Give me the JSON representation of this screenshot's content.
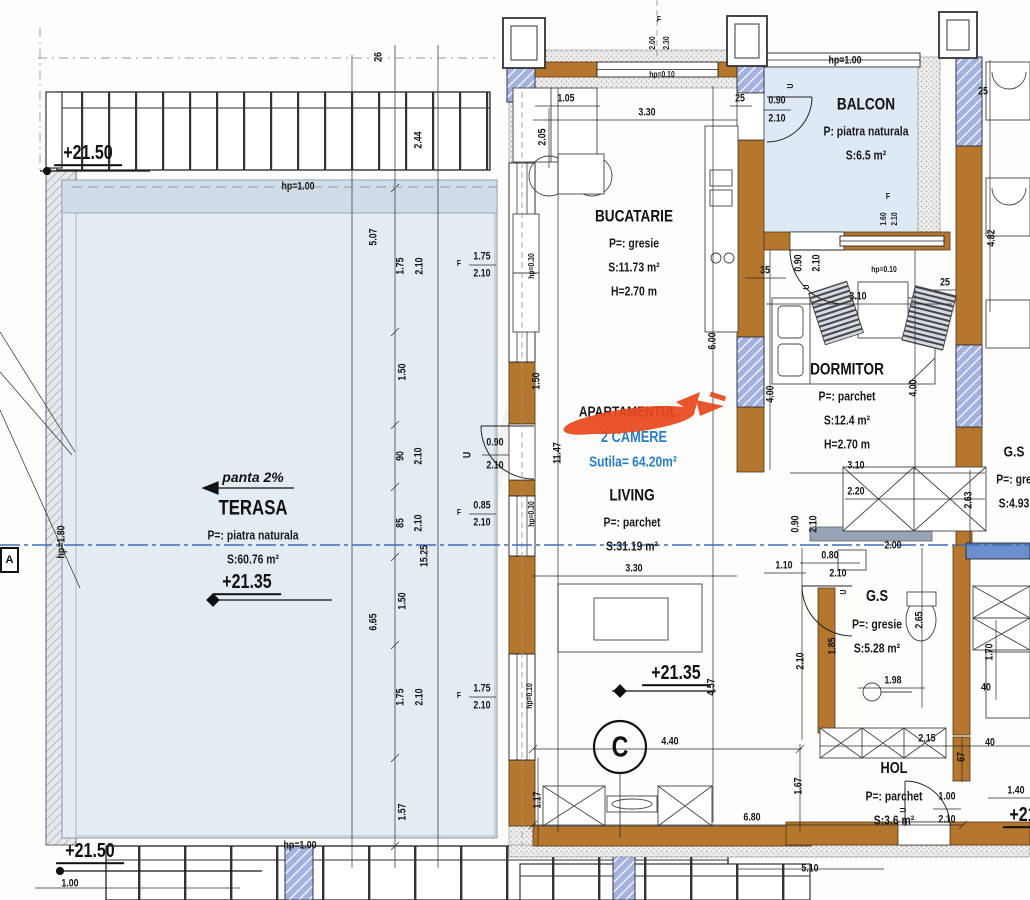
{
  "title_block": {
    "hidden_label": "APARTAMENTUL",
    "rooms_line": "2 CAMERE",
    "area_line": "Sutila= 64.20m²"
  },
  "annotations": {
    "slope": "panta 2%",
    "grid_c": "C",
    "grid_a": "A",
    "watermark": "TM"
  },
  "colors": {
    "wall_brown": "#b5762d",
    "column_blue": "#a3b2de",
    "floor_blue": "#e4ecf3",
    "balcony_blue": "#dde9f5",
    "axis_blue": "#3f6db5",
    "accent_red": "#e8481c",
    "text_blue": "#2b7cc4"
  },
  "rooms": [
    {
      "id": "bucatarie",
      "title": "BUCATARIE",
      "ts": 17,
      "x": 634,
      "y": 216,
      "lines": [
        "P=: gresie",
        "S:11.73 m²",
        "H=2.70 m"
      ]
    },
    {
      "id": "balcon",
      "title": "BALCON",
      "ts": 17,
      "x": 866,
      "y": 104,
      "lines": [
        "P: piatra naturala",
        "S:6.5 m²"
      ]
    },
    {
      "id": "dormitor",
      "title": "DORMITOR",
      "ts": 17,
      "x": 847,
      "y": 369,
      "lines": [
        "P=: parchet",
        "S:12.4 m²",
        "H=2.70 m"
      ]
    },
    {
      "id": "living",
      "title": "LIVING",
      "ts": 17,
      "x": 632,
      "y": 495,
      "lines": [
        "P=: parchet",
        "S:31.19 m²"
      ]
    },
    {
      "id": "terasa",
      "title": "TERASA",
      "ts": 21,
      "x": 253,
      "y": 508,
      "lines": [
        "P=: piatra naturala",
        "S:60.76 m²"
      ]
    },
    {
      "id": "gs-center",
      "title": "G.S",
      "ts": 16,
      "x": 877,
      "y": 597,
      "lines": [
        "P=: gresie",
        "S:5.28 m²"
      ]
    },
    {
      "id": "gs-right",
      "title": "G.S",
      "ts": 15,
      "x": 1014,
      "y": 452,
      "lines": [
        "P=: gre",
        "S:4.93"
      ]
    },
    {
      "id": "hol",
      "title": "HOL",
      "ts": 16,
      "x": 894,
      "y": 769,
      "lines": [
        "P=: parchet",
        "S:3.6 m²"
      ]
    }
  ],
  "elevations": [
    {
      "t": "+21.50",
      "x": 88,
      "y": 157
    },
    {
      "t": "+21.50",
      "x": 90,
      "y": 855
    },
    {
      "t": "+21.35",
      "x": 247,
      "y": 586
    },
    {
      "t": "+21.35",
      "x": 676,
      "y": 677
    },
    {
      "t": "+21",
      "x": 1023,
      "y": 819
    }
  ],
  "dims": [
    {
      "t": "26",
      "x": 379,
      "y": 57,
      "v": 1
    },
    {
      "t": "2.44",
      "x": 419,
      "y": 140,
      "v": 1
    },
    {
      "t": "5.07",
      "x": 374,
      "y": 237,
      "v": 1
    },
    {
      "t": "1.75",
      "x": 401,
      "y": 266,
      "v": 1
    },
    {
      "t": "2.10",
      "x": 420,
      "y": 266,
      "v": 1
    },
    {
      "t": "1.50",
      "x": 403,
      "y": 372,
      "v": 1
    },
    {
      "t": "90",
      "x": 401,
      "y": 456,
      "v": 1
    },
    {
      "t": "2.10",
      "x": 419,
      "y": 456,
      "v": 1
    },
    {
      "t": "85",
      "x": 401,
      "y": 523,
      "v": 1
    },
    {
      "t": "2.10",
      "x": 419,
      "y": 523,
      "v": 1
    },
    {
      "t": "1.50",
      "x": 403,
      "y": 601,
      "v": 1
    },
    {
      "t": "6.65",
      "x": 374,
      "y": 622,
      "v": 1
    },
    {
      "t": "15.25",
      "x": 425,
      "y": 556,
      "v": 1
    },
    {
      "t": "1.75",
      "x": 401,
      "y": 697,
      "v": 1
    },
    {
      "t": "2.10",
      "x": 420,
      "y": 697,
      "v": 1
    },
    {
      "t": "1.57",
      "x": 403,
      "y": 812,
      "v": 1
    },
    {
      "t": "hp=1.00",
      "x": 298,
      "y": 187
    },
    {
      "t": "hp=1.00",
      "x": 300,
      "y": 846
    },
    {
      "t": "1.00",
      "x": 70,
      "y": 884
    },
    {
      "t": "hp=1.80",
      "x": 62,
      "y": 542,
      "v": 1
    },
    {
      "t": "F",
      "x": 659,
      "y": 19,
      "s": 1
    },
    {
      "t": "2.00",
      "x": 652,
      "y": 43,
      "v": 1,
      "s": 1
    },
    {
      "t": "2.30",
      "x": 666,
      "y": 43,
      "v": 1,
      "s": 1
    },
    {
      "t": "hp=0.10",
      "x": 662,
      "y": 74,
      "s": 1
    },
    {
      "t": "1.05",
      "x": 566,
      "y": 99
    },
    {
      "t": "3.30",
      "x": 647,
      "y": 113
    },
    {
      "t": "2.05",
      "x": 543,
      "y": 137,
      "v": 1
    },
    {
      "t": "25",
      "x": 740,
      "y": 99
    },
    {
      "t": "0.90",
      "x": 777,
      "y": 101
    },
    {
      "t": "2.10",
      "x": 777,
      "y": 119
    },
    {
      "t": "U",
      "x": 790,
      "y": 86,
      "v": 1,
      "s": 1
    },
    {
      "t": "hp=1.00",
      "x": 845,
      "y": 61
    },
    {
      "t": "F",
      "x": 888,
      "y": 196,
      "s": 1
    },
    {
      "t": "1.60",
      "x": 883,
      "y": 219,
      "v": 1,
      "s": 1
    },
    {
      "t": "2.10",
      "x": 894,
      "y": 219,
      "v": 1,
      "s": 1
    },
    {
      "t": "35",
      "x": 765,
      "y": 271
    },
    {
      "t": "0.90",
      "x": 799,
      "y": 263,
      "v": 1
    },
    {
      "t": "2.10",
      "x": 817,
      "y": 263,
      "v": 1
    },
    {
      "t": "U",
      "x": 806,
      "y": 287,
      "v": 1,
      "s": 1
    },
    {
      "t": "hp=0.10",
      "x": 884,
      "y": 269,
      "s": 1
    },
    {
      "t": "25",
      "x": 945,
      "y": 283
    },
    {
      "t": "3.10",
      "x": 858,
      "y": 297
    },
    {
      "t": "25",
      "x": 983,
      "y": 92
    },
    {
      "t": "4.82",
      "x": 992,
      "y": 238,
      "v": 1
    },
    {
      "t": "6.00",
      "x": 713,
      "y": 341,
      "v": 1
    },
    {
      "t": "4.00",
      "x": 771,
      "y": 394,
      "v": 1
    },
    {
      "t": "4.00",
      "x": 914,
      "y": 388,
      "v": 1
    },
    {
      "t": "11.47",
      "x": 558,
      "y": 453,
      "v": 1
    },
    {
      "t": "1.50",
      "x": 537,
      "y": 381,
      "v": 1
    },
    {
      "t": "U",
      "x": 468,
      "y": 455,
      "v": 1
    },
    {
      "t": "0.90",
      "x": 495,
      "y": 443
    },
    {
      "t": "2.10",
      "x": 495,
      "y": 466
    },
    {
      "t": "F",
      "x": 459,
      "y": 263,
      "s": 1
    },
    {
      "t": "1.75",
      "x": 482,
      "y": 257
    },
    {
      "t": "2.10",
      "x": 482,
      "y": 274
    },
    {
      "t": "hp=0.30",
      "x": 531,
      "y": 266,
      "v": 1,
      "s": 1
    },
    {
      "t": "F",
      "x": 459,
      "y": 512,
      "s": 1
    },
    {
      "t": "0.85",
      "x": 482,
      "y": 506
    },
    {
      "t": "2.10",
      "x": 482,
      "y": 523
    },
    {
      "t": "hp=0.30",
      "x": 531,
      "y": 514,
      "v": 1,
      "s": 1
    },
    {
      "t": "F",
      "x": 459,
      "y": 695,
      "s": 1
    },
    {
      "t": "1.75",
      "x": 482,
      "y": 689
    },
    {
      "t": "2.10",
      "x": 482,
      "y": 706
    },
    {
      "t": "hp=0.10",
      "x": 529,
      "y": 696,
      "v": 1,
      "s": 1
    },
    {
      "t": "3.10",
      "x": 856,
      "y": 466
    },
    {
      "t": "2.20",
      "x": 856,
      "y": 492
    },
    {
      "t": "0.90",
      "x": 796,
      "y": 524,
      "v": 1
    },
    {
      "t": "2.10",
      "x": 814,
      "y": 524,
      "v": 1
    },
    {
      "t": "2.63",
      "x": 969,
      "y": 500,
      "v": 1
    },
    {
      "t": "2.00",
      "x": 893,
      "y": 546
    },
    {
      "t": "0.80",
      "x": 830,
      "y": 556
    },
    {
      "t": "1.10",
      "x": 784,
      "y": 566
    },
    {
      "t": "2.10",
      "x": 838,
      "y": 574
    },
    {
      "t": "U",
      "x": 843,
      "y": 592,
      "v": 1,
      "s": 1
    },
    {
      "t": "2.10",
      "x": 801,
      "y": 661,
      "v": 1
    },
    {
      "t": "2.65",
      "x": 920,
      "y": 620,
      "v": 1
    },
    {
      "t": "1.85",
      "x": 833,
      "y": 646,
      "v": 1
    },
    {
      "t": "1.98",
      "x": 893,
      "y": 681
    },
    {
      "t": "1.70",
      "x": 990,
      "y": 652,
      "v": 1
    },
    {
      "t": "40",
      "x": 986,
      "y": 688
    },
    {
      "t": "3.30",
      "x": 634,
      "y": 569
    },
    {
      "t": "4.57",
      "x": 712,
      "y": 687,
      "v": 1
    },
    {
      "t": "4.40",
      "x": 670,
      "y": 742
    },
    {
      "t": "1.17",
      "x": 538,
      "y": 800,
      "v": 1
    },
    {
      "t": "6.80",
      "x": 752,
      "y": 818
    },
    {
      "t": "1.67",
      "x": 799,
      "y": 786,
      "v": 1
    },
    {
      "t": "2.15",
      "x": 927,
      "y": 739
    },
    {
      "t": "40",
      "x": 990,
      "y": 743
    },
    {
      "t": "67",
      "x": 962,
      "y": 757,
      "v": 1
    },
    {
      "t": "1.00",
      "x": 947,
      "y": 797
    },
    {
      "t": "2.10",
      "x": 947,
      "y": 820
    },
    {
      "t": "U",
      "x": 903,
      "y": 810,
      "v": 1,
      "s": 1
    },
    {
      "t": "1.40",
      "x": 1016,
      "y": 791
    },
    {
      "t": "5.10",
      "x": 810,
      "y": 869
    }
  ]
}
